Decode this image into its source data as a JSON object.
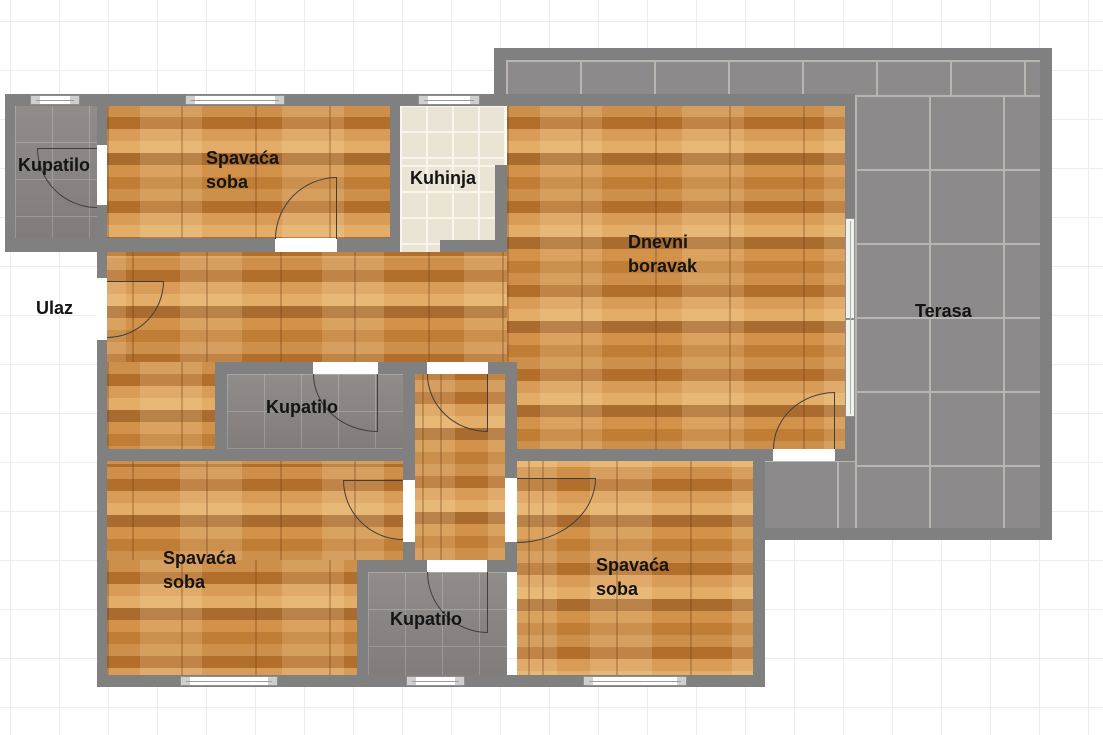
{
  "plan": {
    "type": "apartment-floor-plan",
    "rooms": [
      {
        "id": "bathroom-top-left",
        "label": "Kupatilo",
        "floor": "bathroom-tile"
      },
      {
        "id": "bedroom-top",
        "label": "Spavaća soba",
        "floor": "wood-parquet"
      },
      {
        "id": "kitchen",
        "label": "Kuhinja",
        "floor": "kitchen-tile"
      },
      {
        "id": "living-room",
        "label": "Dnevni boravak",
        "floor": "wood-parquet"
      },
      {
        "id": "terrace",
        "label": "Terasa",
        "floor": "terrace-tile"
      },
      {
        "id": "entrance",
        "label": "Ulaz",
        "floor": "outside"
      },
      {
        "id": "bathroom-middle",
        "label": "Kupatilo",
        "floor": "bathroom-tile"
      },
      {
        "id": "bedroom-bottom-left",
        "label": "Spavaća soba",
        "floor": "wood-parquet"
      },
      {
        "id": "bathroom-bottom",
        "label": "Kupatilo",
        "floor": "bathroom-tile"
      },
      {
        "id": "bedroom-bottom-right",
        "label": "Spavaća soba",
        "floor": "wood-parquet"
      }
    ],
    "colors": {
      "wall": "#808080",
      "wood_floor": "#c78a43",
      "bathroom_tile": "#8b8684",
      "terrace_tile": "#8d8a8b",
      "kitchen_tile": "#e9e4d3",
      "door_line": "#3f3f3f",
      "window_fill": "#ffffff",
      "label_text": "#141414",
      "background_grid": "#ececec"
    }
  }
}
